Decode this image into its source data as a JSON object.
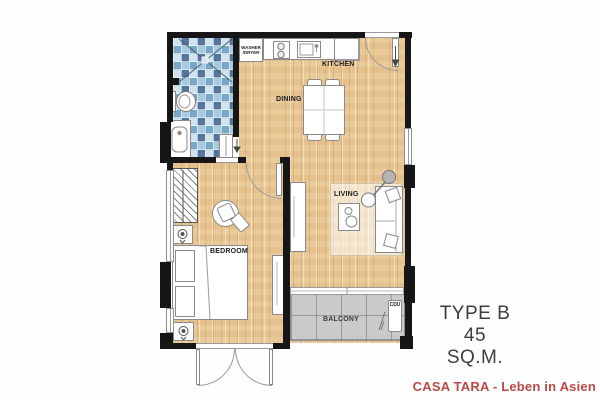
{
  "plan": {
    "title": "TYPE B",
    "area": "45 SQ.M.",
    "footer": "CASA TARA - Leben in Asien",
    "rooms": {
      "kitchen": {
        "label": "KITCHEN"
      },
      "dining": {
        "label": "DINING"
      },
      "living": {
        "label": "LIVING"
      },
      "bedroom": {
        "label": "BEDROOM"
      },
      "balcony": {
        "label": "BALCONY"
      }
    },
    "fixtures": {
      "washer_line1": "WASHER",
      "washer_line2": "/DRYER",
      "cdu": "CDU"
    },
    "colors": {
      "wood_floor": "#EAC795",
      "bathroom_tile": "#8FB6D2",
      "balcony_floor": "#CACACA",
      "wall": "#161616",
      "title_text": "#3D3D3D",
      "footer_accent": "#B94A48"
    }
  }
}
